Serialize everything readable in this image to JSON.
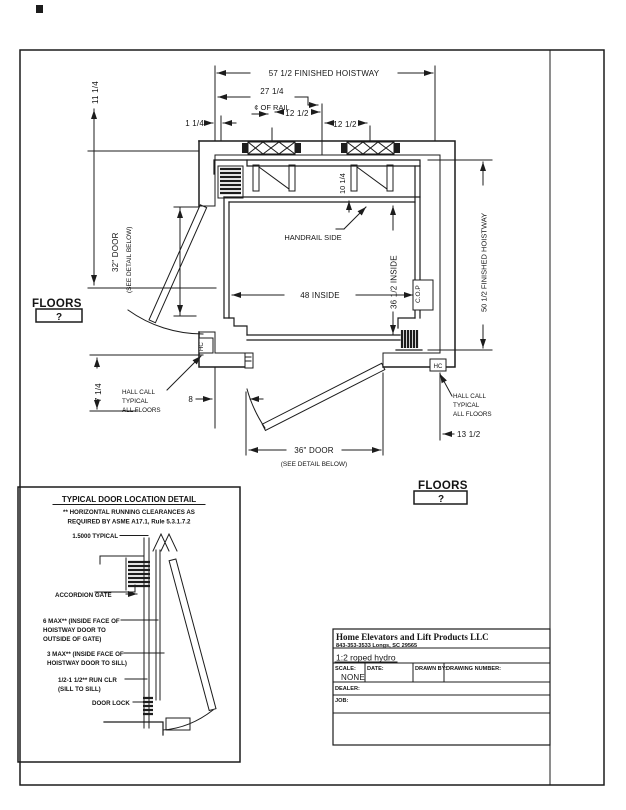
{
  "plan": {
    "dim_top_width": "57 1/2 FINISHED HOISTWAY",
    "dim_rail_offset": "27 1/4",
    "label_rail_cl": "¢ OF RAIL",
    "dim_rail_left": "12 1/2",
    "dim_rail_right": "12 1/2",
    "dim_wall_clear": "1 1/4",
    "dim_left_upper": "11 1/4",
    "door_left_label": "32\" DOOR",
    "door_left_sub": "(SEE DETAIL BELOW)",
    "dim_handrail": "10 1/4",
    "label_handrail": "HANDRAIL SIDE",
    "dim_inside_width": "48 INSIDE",
    "dim_inside_depth": "36 1/2 INSIDE",
    "label_cop": "C.O.P",
    "dim_right_height": "50 1/2 FINISHED HOISTWAY",
    "dim_left_lower": "7 1/4",
    "dim_door_offset": "8",
    "label_hc": "HC",
    "hall_call_left": [
      "HALL CALL",
      "TYPICAL",
      "ALL FLOORS"
    ],
    "hall_call_right": [
      "HALL CALL",
      "TYPICAL",
      "ALL FLOORS"
    ],
    "door_bottom_label": "36\" DOOR",
    "door_bottom_sub": "(SEE DETAIL BELOW)",
    "dim_right_offset": "13 1/2",
    "floors_label": "FLOORS",
    "floors_value": "?"
  },
  "detail": {
    "title": "TYPICAL DOOR LOCATION DETAIL",
    "note1": "** HORIZONTAL RUNNING CLEARANCES AS",
    "note2": "REQUIRED BY ASME A17.1, Rule 5.3.1.7.2",
    "typical": "1.5000 TYPICAL",
    "gate": "ACCORDION GATE",
    "max_gate_1": "6 MAX** (INSIDE FACE OF",
    "max_gate_2": "HOISTWAY DOOR TO",
    "max_gate_3": "OUTSIDE OF GATE)",
    "max_sill_1": "3 MAX** (INSIDE FACE OF",
    "max_sill_2": "HOISTWAY DOOR TO SILL)",
    "run_clr_1": "1/2-1 1/2** RUN CLR",
    "run_clr_2": "(SILL TO SILL)",
    "lock": "DOOR LOCK"
  },
  "titleblock": {
    "company": "Home Elevators and Lift Products LLC",
    "address": "843-353-3533   Longs, SC 29565",
    "model": "1:2 roped hydro",
    "scale_label": "SCALE:",
    "scale_value": "NONE",
    "date_label": "DATE:",
    "drawn_label": "DRAWN BY:",
    "number_label": "DRAWING NUMBER:",
    "dealer_label": "DEALER:",
    "job_label": "JOB:"
  }
}
